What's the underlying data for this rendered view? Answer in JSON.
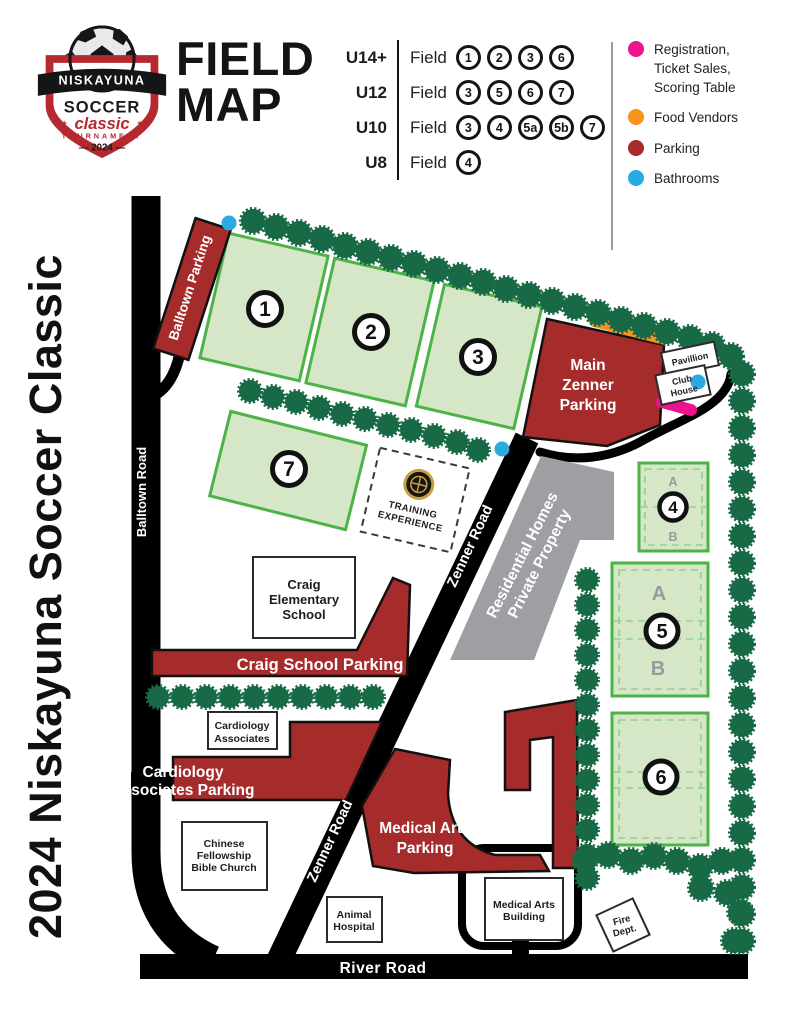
{
  "side_title": "2024 Niskayuna Soccer Classic",
  "title": {
    "line1": "FIELD",
    "line2": "MAP"
  },
  "logo": {
    "niskayuna": "NISKAYUNA",
    "soccer": "SOCCER",
    "classic": "classic",
    "tournament": "TOURNAMENT",
    "year_display": "— 2024 —",
    "star": "★"
  },
  "age_groups": [
    {
      "label": "U14+",
      "field_word": "Field",
      "fields": [
        "1",
        "2",
        "3",
        "6"
      ]
    },
    {
      "label": "U12",
      "field_word": "Field",
      "fields": [
        "3",
        "5",
        "6",
        "7"
      ]
    },
    {
      "label": "U10",
      "field_word": "Field",
      "fields": [
        "3",
        "4",
        "5a",
        "5b",
        "7"
      ]
    },
    {
      "label": "U8",
      "field_word": "Field",
      "fields": [
        "4"
      ]
    }
  ],
  "legend": {
    "items": [
      {
        "name": "registration",
        "color": "#EC148C",
        "lines": [
          "Registration,",
          "Ticket Sales,",
          "Scoring Table"
        ]
      },
      {
        "name": "food-vendors",
        "color": "#F7941E",
        "lines": [
          "Food Vendors"
        ]
      },
      {
        "name": "parking",
        "color": "#A62C2C",
        "lines": [
          "Parking"
        ]
      },
      {
        "name": "bathrooms",
        "color": "#29ABE2",
        "lines": [
          "Bathrooms"
        ]
      }
    ]
  },
  "map": {
    "colors": {
      "road": "#000000",
      "parking": "#A62C2C",
      "field_fill": "#D5E7C6",
      "field_border": "#4DB349",
      "tree": "#186945",
      "residential": "#9D9FA2",
      "bathroom": "#29ABE2",
      "food_vendor": "#F7941E",
      "registration": "#EC148C"
    },
    "roads": {
      "balltown": "Balltown Road",
      "zenner": "Zenner Road",
      "river": "River Road"
    },
    "parking": {
      "balltown": "Balltown Parking",
      "main1": "Main",
      "main2": "Zenner",
      "main3": "Parking",
      "craig": "Craig School Parking",
      "cardio1": "Cardiology",
      "cardio2": "Associates Parking",
      "medical1": "Medical Arts",
      "medical2": "Parking"
    },
    "places": {
      "pavilion": "Pavillion",
      "club1": "Club",
      "club2": "House",
      "school1": "Craig",
      "school2": "Elementary",
      "school3": "School",
      "cardio1": "Cardiology",
      "cardio2": "Associates",
      "church1": "Chinese",
      "church2": "Fellowship",
      "church3": "Bible Church",
      "animal1": "Animal",
      "animal2": "Hospital",
      "medical1": "Medical Arts",
      "medical2": "Building",
      "fire1": "Fire",
      "fire2": "Dept.",
      "residential1": "Residential Homes",
      "residential2": "Private Property",
      "training1": "TRAINING",
      "training2": "EXPERIENCE"
    },
    "field_numbers": {
      "f1": "1",
      "f2": "2",
      "f3": "3",
      "f4": "4",
      "f5": "5",
      "f6": "6",
      "f7": "7"
    },
    "sub_labels": {
      "a": "A",
      "b": "B"
    }
  }
}
